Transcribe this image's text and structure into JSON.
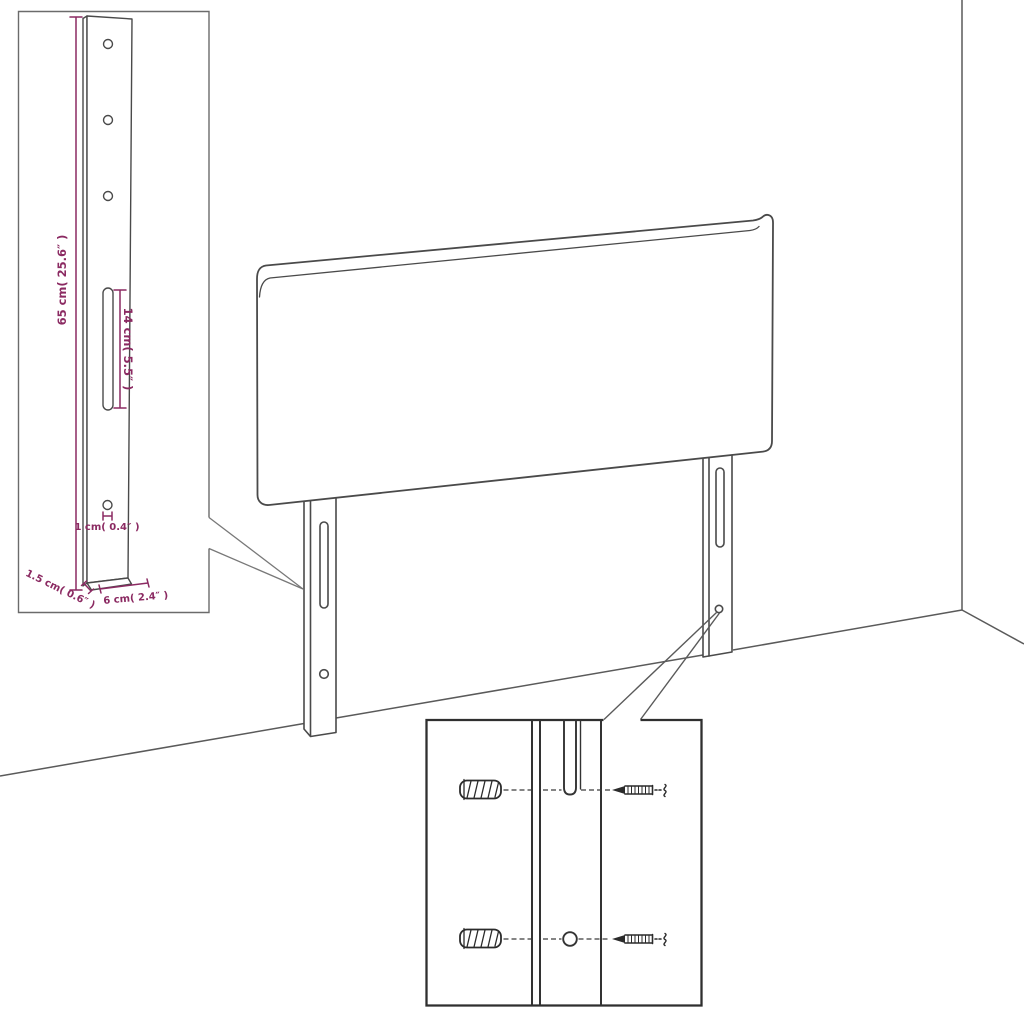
{
  "diagram": {
    "type": "furniture-assembly-dimension-diagram",
    "subject": "headboard with two mounting legs in a room corner",
    "parts": [
      "headboard-panel",
      "mounting-leg-left",
      "mounting-leg-right",
      "wall-plug",
      "screw",
      "mounting-slot",
      "screw-hole"
    ],
    "labels": {
      "leg_height": "65 cm( 25.6″ )",
      "slot_length": "14 cm( 5.5″ )",
      "hole_diameter": "1 cm( 0.4″ )",
      "leg_thickness": "1.5 cm( 0.6″ )",
      "leg_width": "6 cm( 2.4″ )"
    },
    "colors": {
      "background": "#ffffff",
      "outline": "#4a4a4a",
      "inset_outline": "#2f2f2f",
      "dimension": "#8b2a62"
    }
  }
}
